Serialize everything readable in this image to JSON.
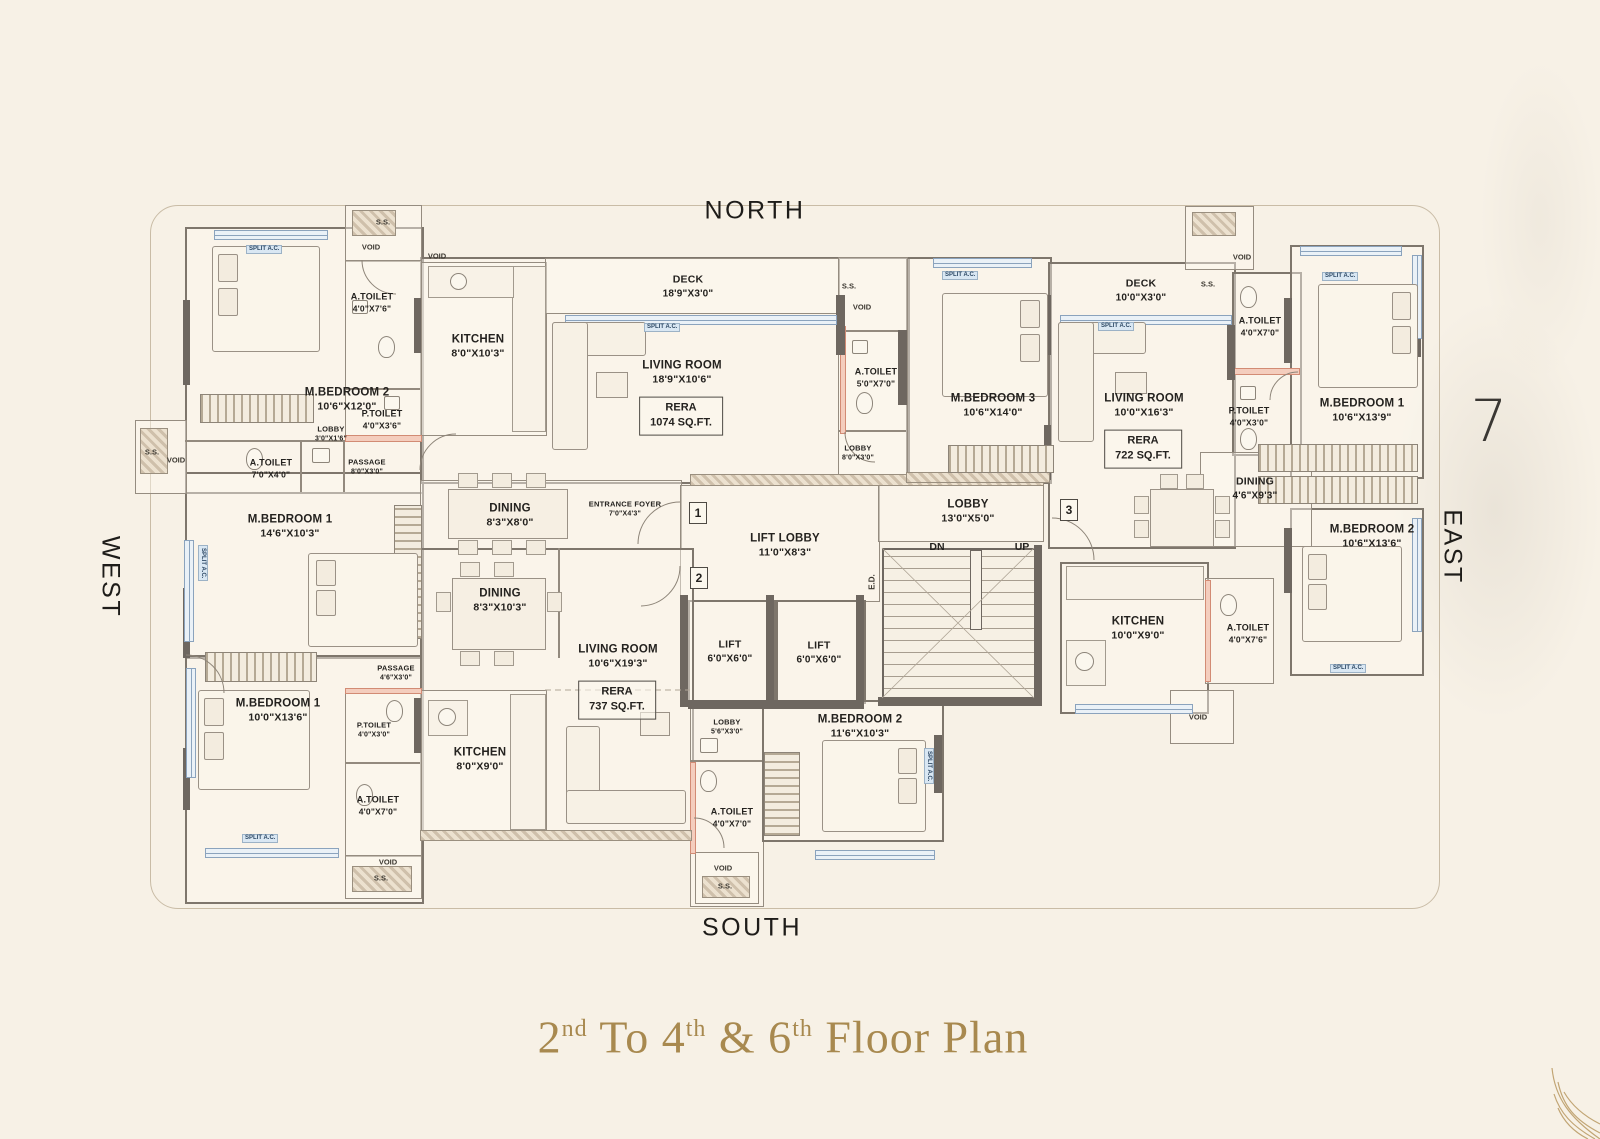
{
  "compass": {
    "north": "NORTH",
    "south": "SOUTH",
    "east": "EAST",
    "west": "WEST"
  },
  "floor_number": "7",
  "title": {
    "p1": "2",
    "s1": "nd",
    "p2": " To 4",
    "s2": "th",
    "p3": " & 6",
    "s3": "th",
    "p4": " Floor Plan"
  },
  "rooms": [
    {
      "name": "M.BEDROOM 2",
      "dims": "10'6\"X12'0\""
    },
    {
      "name": "A.TOILET",
      "dims": "4'0\"X7'6\""
    },
    {
      "name": "KITCHEN",
      "dims": "8'0\"X10'3\""
    },
    {
      "name": "P.TOILET",
      "dims": "4'0\"X3'6\""
    },
    {
      "name": "LOBBY",
      "dims": "3'0\"X1'6\""
    },
    {
      "name": "A.TOILET",
      "dims": "7'0\"X4'0\""
    },
    {
      "name": "PASSAGE",
      "dims": "8'0\"X3'0\""
    },
    {
      "name": "DECK",
      "dims": "18'9\"X3'0\""
    },
    {
      "name": "LIVING ROOM",
      "dims": "18'9\"X10'6\""
    },
    {
      "name": "A.TOILET",
      "dims": "5'0\"X7'0\""
    },
    {
      "name": "LOBBY",
      "dims": "8'0\"X3'0\""
    },
    {
      "name": "M.BEDROOM 3",
      "dims": "10'6\"X14'0\""
    },
    {
      "name": "DECK",
      "dims": "10'0\"X3'0\""
    },
    {
      "name": "LIVING ROOM",
      "dims": "10'0\"X16'3\""
    },
    {
      "name": "A.TOILET",
      "dims": "4'0\"X7'0\""
    },
    {
      "name": "P.TOILET",
      "dims": "4'0\"X3'0\""
    },
    {
      "name": "DINING",
      "dims": "4'6\"X9'3\""
    },
    {
      "name": "M.BEDROOM 1",
      "dims": "10'6\"X13'9\""
    },
    {
      "name": "M.BEDROOM 2",
      "dims": "10'6\"X13'6\""
    },
    {
      "name": "LIFT LOBBY",
      "dims": "11'0\"X8'3\""
    },
    {
      "name": "LOBBY",
      "dims": "13'0\"X5'0\""
    },
    {
      "name": "LIFT",
      "dims": "6'0\"X6'0\""
    },
    {
      "name": "LIFT",
      "dims": "6'0\"X6'0\""
    },
    {
      "name": "M.BEDROOM 1",
      "dims": "14'6\"X10'3\""
    },
    {
      "name": "PASSAGE",
      "dims": "4'6\"X3'0\""
    },
    {
      "name": "M.BEDROOM 1",
      "dims": "10'0\"X13'6\""
    },
    {
      "name": "P.TOILET",
      "dims": "4'0\"X3'0\""
    },
    {
      "name": "A.TOILET",
      "dims": "4'0\"X7'0\""
    },
    {
      "name": "KITCHEN",
      "dims": "8'0\"X9'0\""
    },
    {
      "name": "DINING",
      "dims": "8'3\"X10'3\""
    },
    {
      "name": "LIVING ROOM",
      "dims": "10'6\"X19'3\""
    },
    {
      "name": "DINING",
      "dims": "8'3\"X8'0\""
    },
    {
      "name": "ENTRANCE FOYER",
      "dims": "7'0\"X4'3\""
    },
    {
      "name": "LOBBY",
      "dims": "5'6\"X3'0\""
    },
    {
      "name": "A.TOILET",
      "dims": "4'0\"X7'0\""
    },
    {
      "name": "M.BEDROOM 2",
      "dims": "11'6\"X10'3\""
    },
    {
      "name": "KITCHEN",
      "dims": "10'0\"X9'0\""
    },
    {
      "name": "A.TOILET",
      "dims": "4'0\"X7'6\""
    }
  ],
  "rera": [
    {
      "label": "RERA",
      "value": "1074 SQ.FT."
    },
    {
      "label": "RERA",
      "value": "722 SQ.FT."
    },
    {
      "label": "RERA",
      "value": "737 SQ.FT."
    }
  ],
  "stairs": {
    "dn": "DN",
    "up": "UP"
  },
  "electrical_duct": "E.D.",
  "unit_numbers": [
    "1",
    "2",
    "3"
  ],
  "tiny": {
    "void": "VOID",
    "ss": "S.S.",
    "split_ac": "SPLIT A.C."
  }
}
